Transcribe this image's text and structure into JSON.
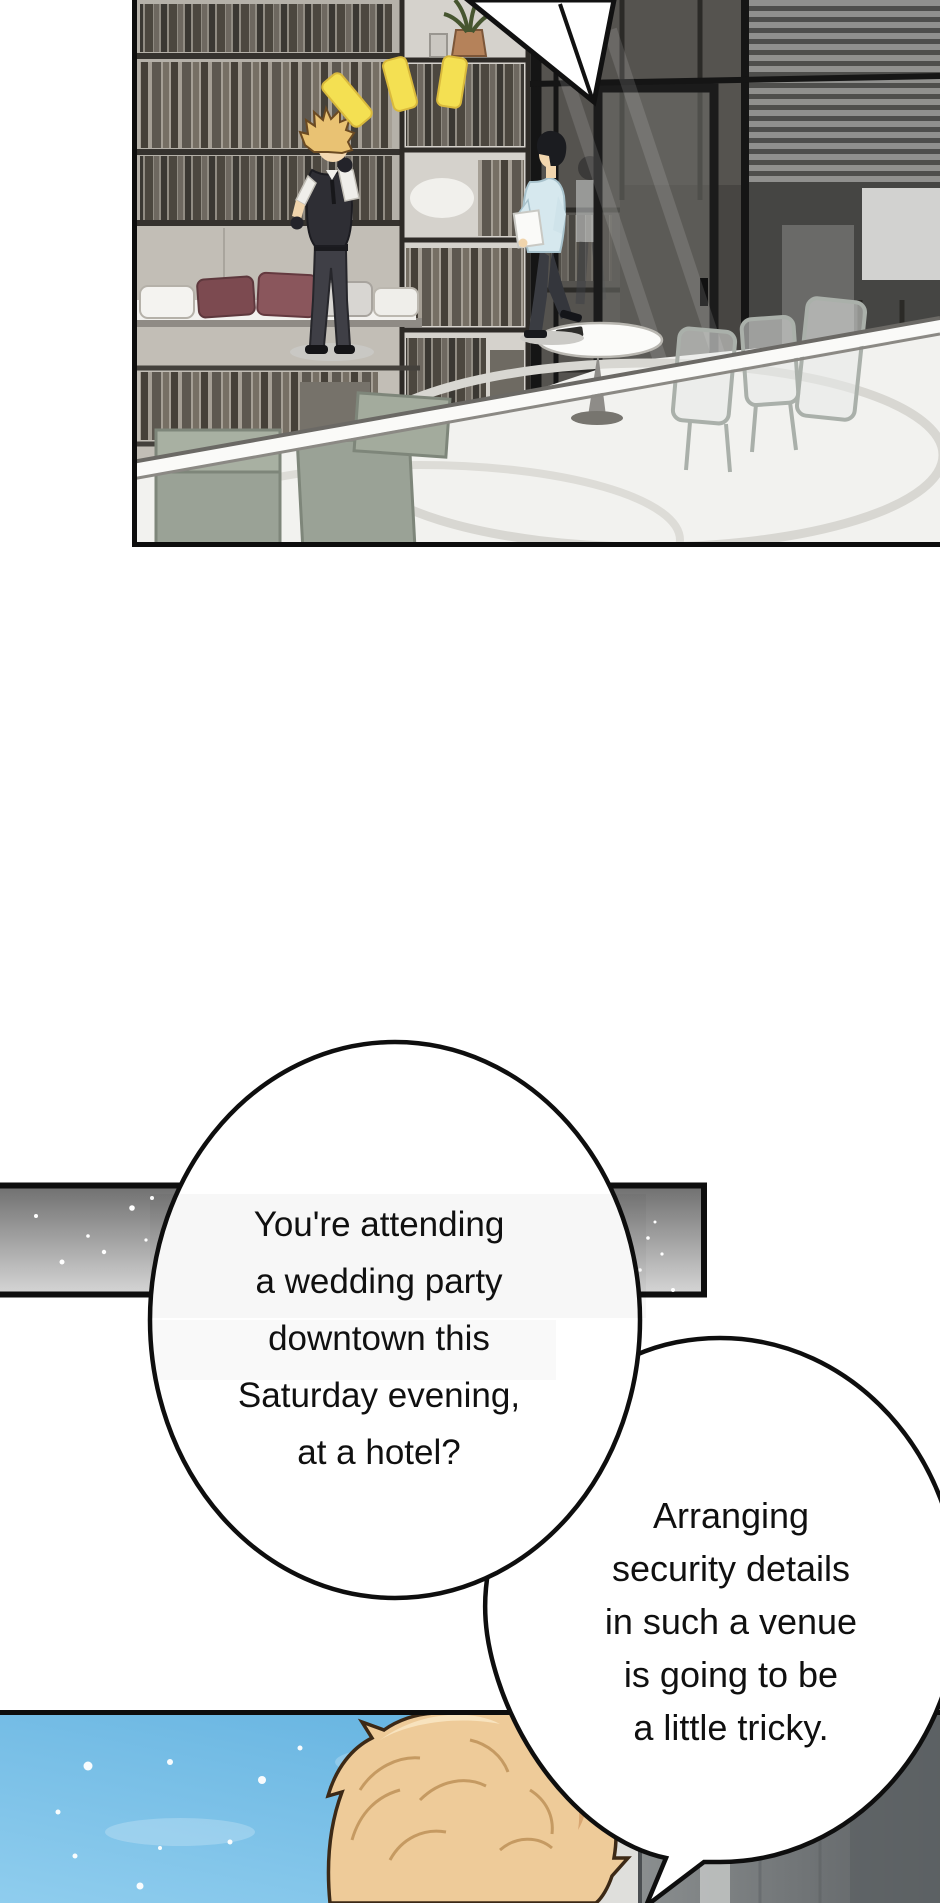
{
  "comic": {
    "bubbles": {
      "first": {
        "lines": [
          "You're attending",
          "a wedding party",
          "downtown this",
          "Saturday evening,",
          "at a hotel?"
        ]
      },
      "second": {
        "lines": [
          "Arranging",
          "security details",
          "in such a venue",
          "is going to be",
          "a little tricky."
        ]
      }
    },
    "colors": {
      "panel_border": "#0d0d0d",
      "bubble_fill": "#ffffff",
      "bubble_stroke": "#0e0e0e",
      "text_color": "#101010",
      "divider_bar_top": "#6f6f6f",
      "divider_bar_bottom": "#d6d6d6",
      "sky_blue": "#5fb0df",
      "sky_blue_light": "#8fcdee",
      "hair_blond": "#eecb99",
      "surprise_mark_yellow": "#f4e052",
      "office_wall": "#c2beb6",
      "shirt_light_blue": "#d6e8ee"
    }
  }
}
